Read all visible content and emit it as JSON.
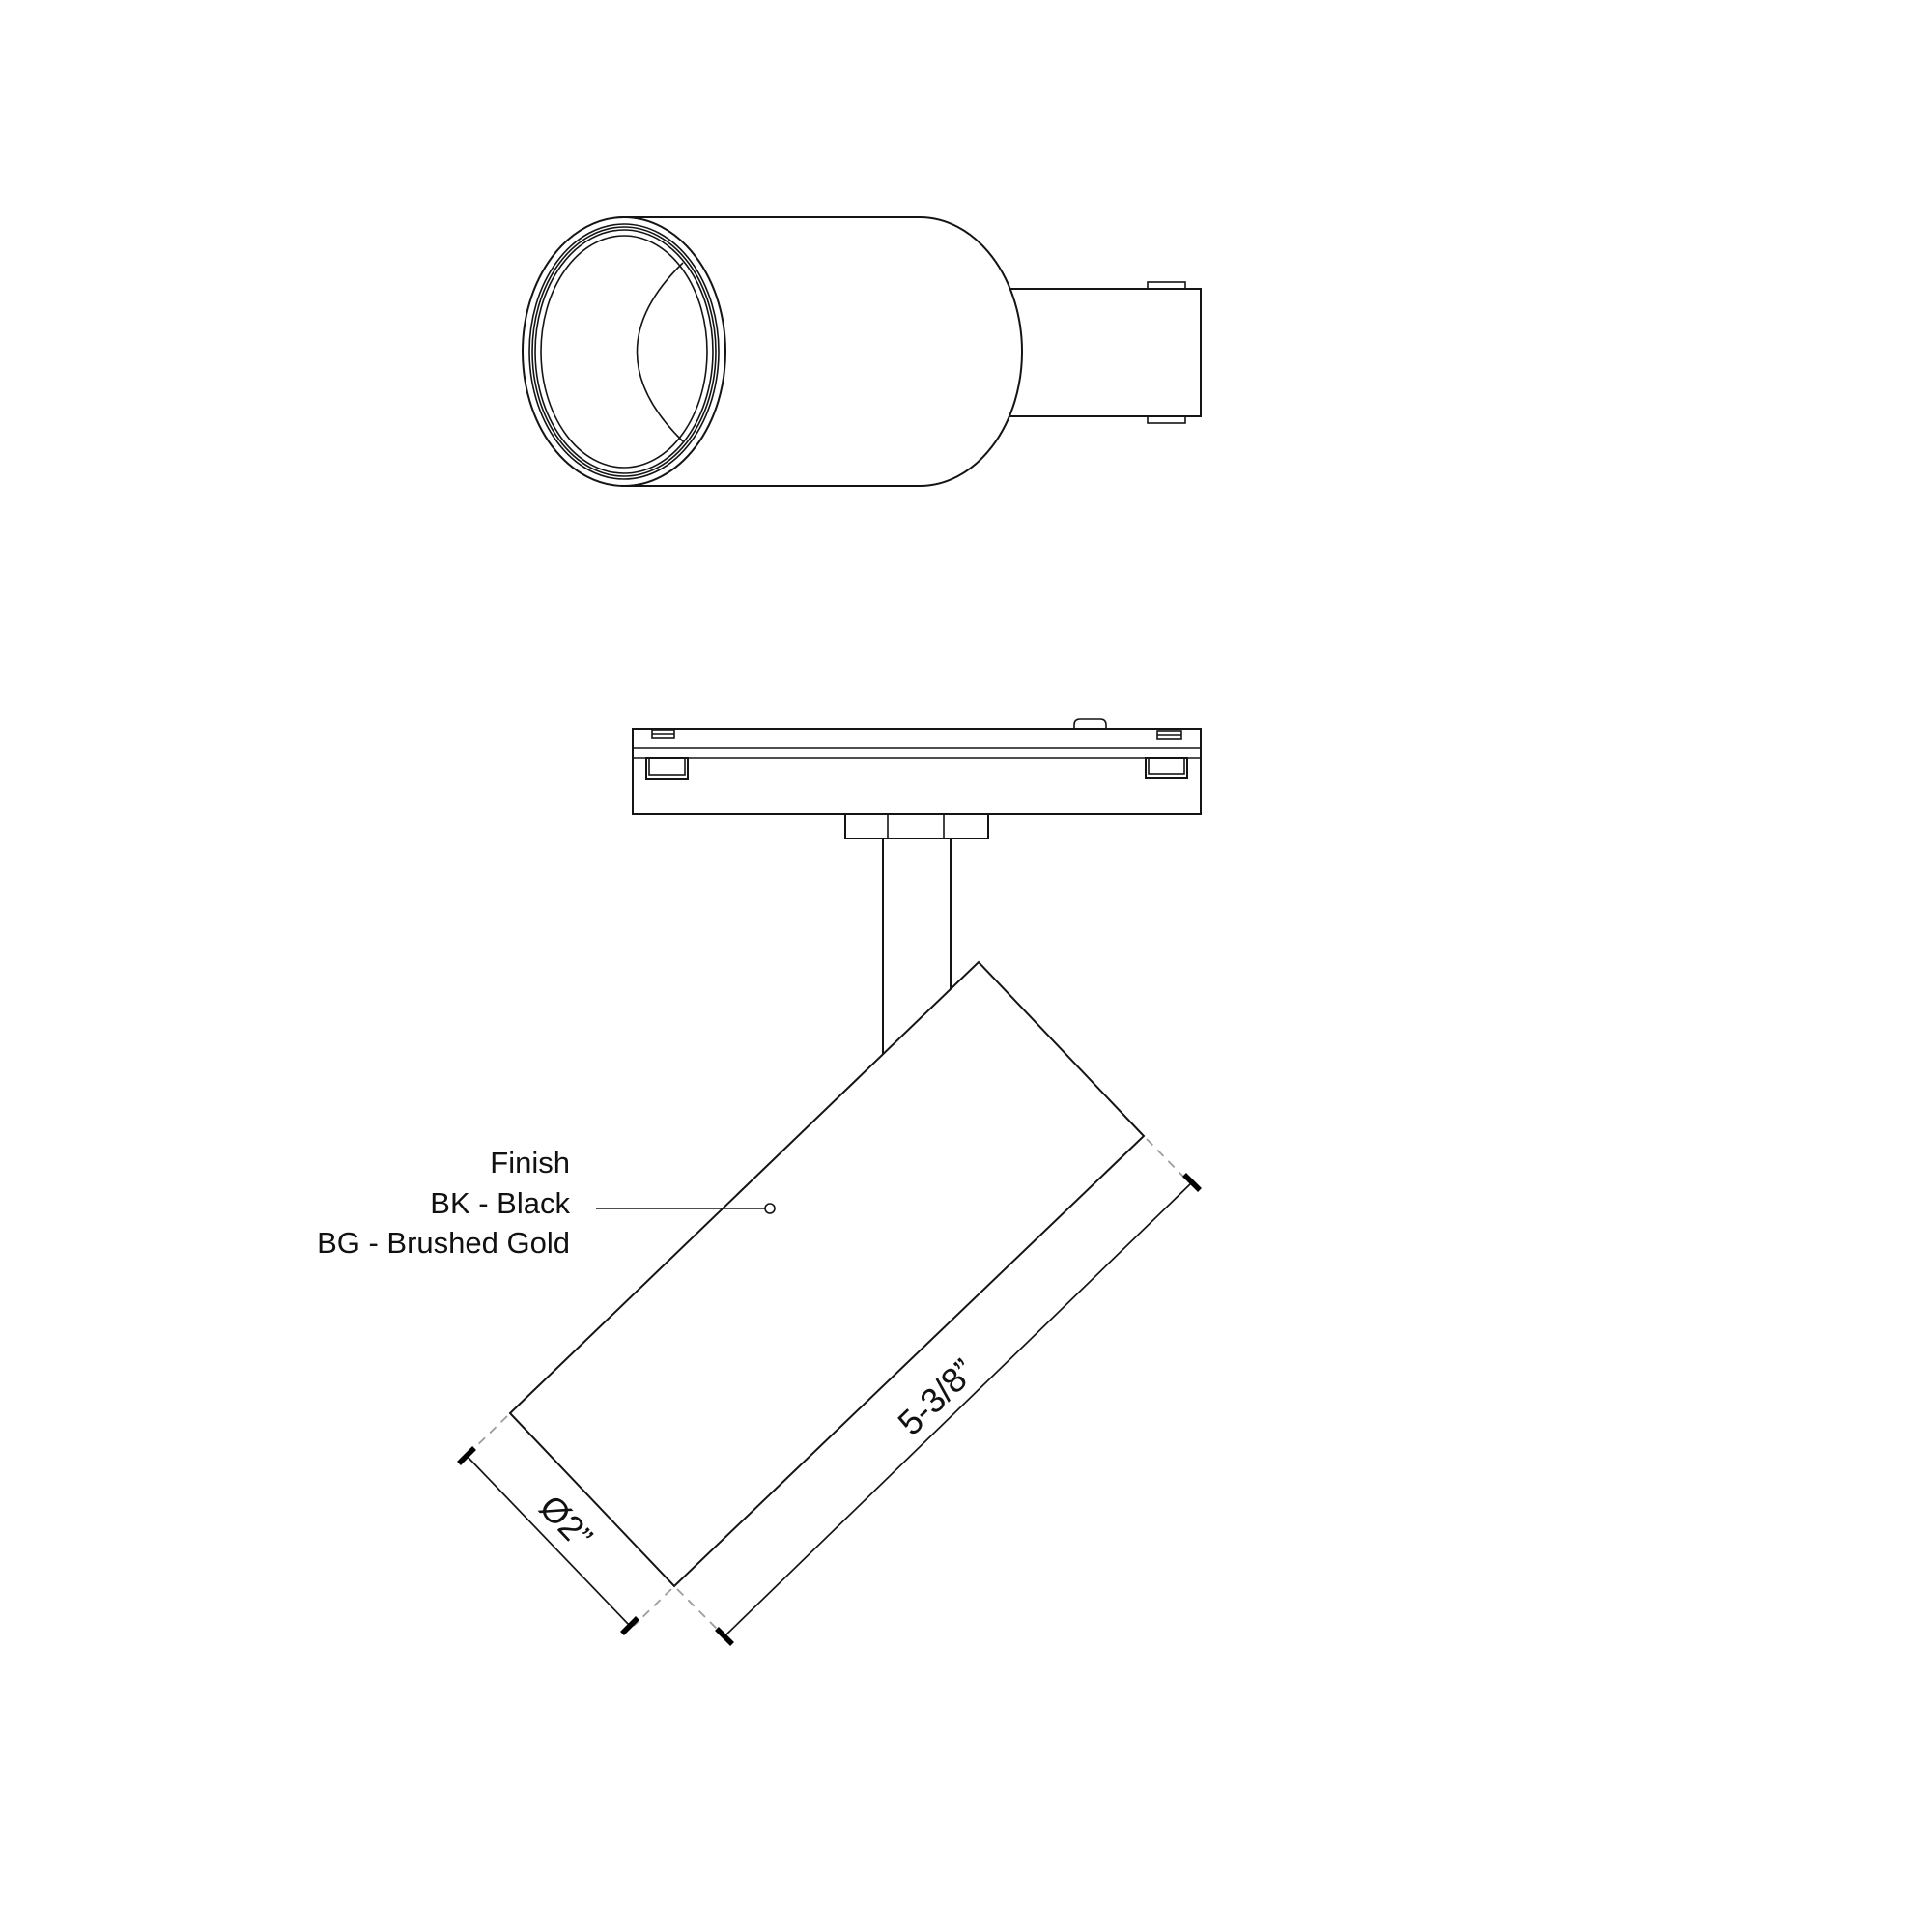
{
  "page": {
    "background": "#ffffff"
  },
  "drawing": {
    "line_color": "#141414",
    "extension_dash_color": "#9d9d9d",
    "finish_note": {
      "title": "Finish",
      "option_black": "BK - Black",
      "option_gold": "BG - Brushed Gold"
    },
    "dimensions": {
      "body_length": "5-3/8”",
      "body_diameter": "Ø2”"
    }
  }
}
